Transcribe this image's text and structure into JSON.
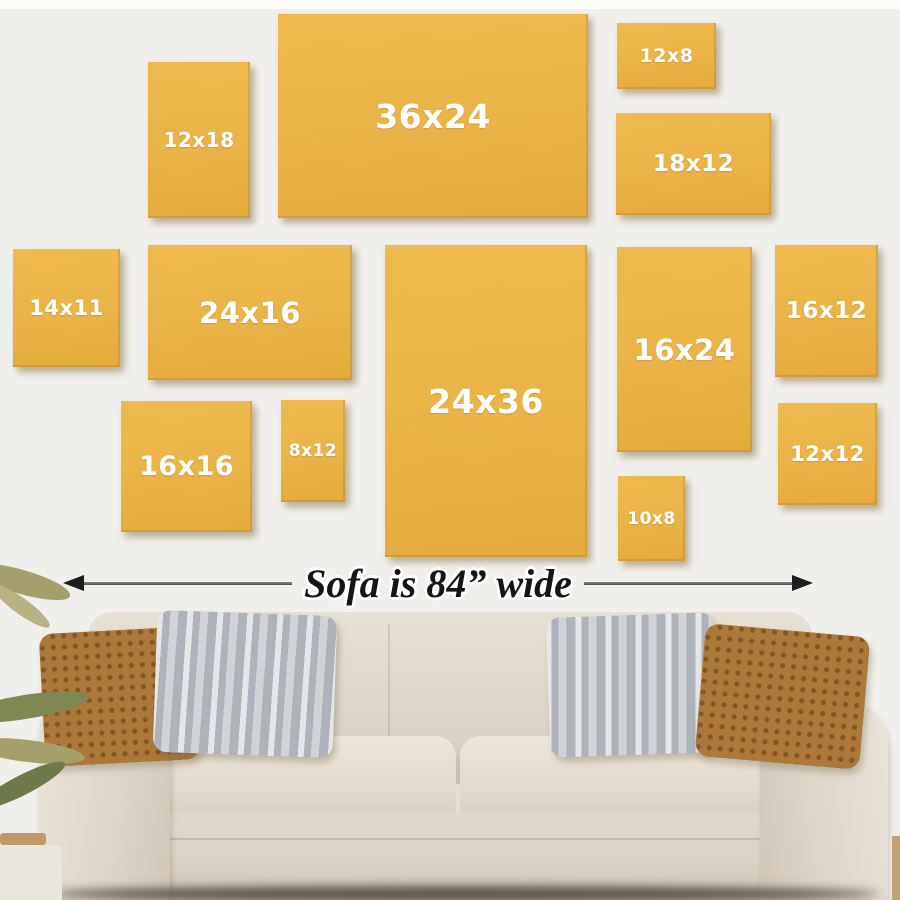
{
  "frames": [
    {
      "label": "12x18"
    },
    {
      "label": "36x24"
    },
    {
      "label": "12x8"
    },
    {
      "label": "18x12"
    },
    {
      "label": "14x11"
    },
    {
      "label": "24x16"
    },
    {
      "label": "24x36"
    },
    {
      "label": "16x24"
    },
    {
      "label": "16x12"
    },
    {
      "label": "16x16"
    },
    {
      "label": "8x12"
    },
    {
      "label": "10x8"
    },
    {
      "label": "12x12"
    }
  ],
  "arrow_note": {
    "text": "Sofa is 84” wide"
  },
  "colors": {
    "frame_yellow": "#eab347",
    "frame_label": "#ffffff",
    "wall": "#f1efeb",
    "arrow_black": "#1d1d1d",
    "sofa_beige": "#ded6ca",
    "pillow_brown": "#ac793a",
    "pillow_gray": "#c6c8cd"
  }
}
